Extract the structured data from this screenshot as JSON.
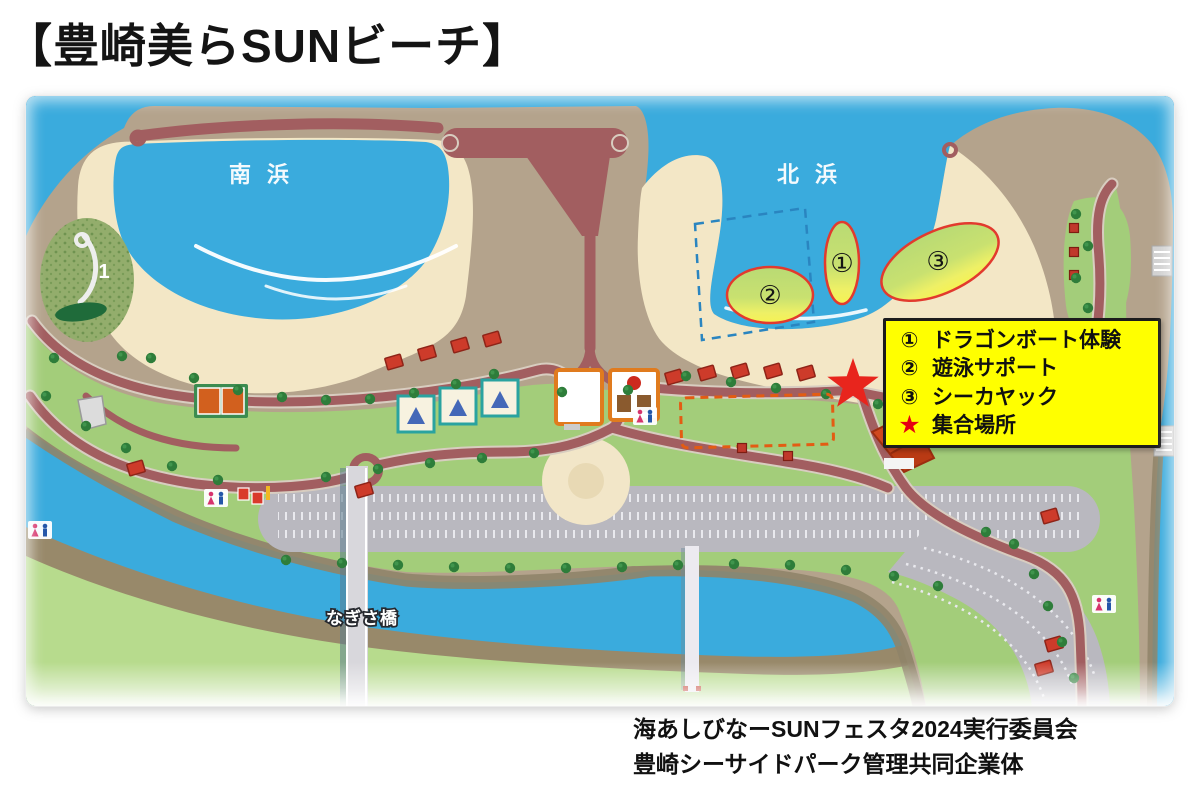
{
  "page": {
    "title": "【豊崎美らSUNビーチ】",
    "credits": [
      "海あしびなーSUNフェスタ2024実行委員会",
      "豊崎シーサイドパーク管理共同企業体"
    ]
  },
  "map": {
    "south_beach_label": "南浜",
    "north_beach_label": "北浜",
    "bridge_label": "なぎさ橋",
    "garden_marker": "1",
    "activities": [
      {
        "symbol": "①",
        "name": "ドラゴンボート体験"
      },
      {
        "symbol": "②",
        "name": "遊泳サポート"
      },
      {
        "symbol": "③",
        "name": "シーカヤック"
      }
    ],
    "meeting_point": {
      "symbol": "★",
      "name": "集合場所"
    }
  },
  "legend": {
    "items": [
      {
        "symbol": "①",
        "label": "ドラゴンボート体験"
      },
      {
        "symbol": "②",
        "label": "遊泳サポート"
      },
      {
        "symbol": "③",
        "label": "シーカヤック"
      },
      {
        "symbol": "★",
        "label": "集合場所"
      }
    ],
    "background": "#ffff00",
    "border": "#1c1c1c"
  },
  "palette": {
    "water": "#3aabdd",
    "sand": "#f3e7c6",
    "park_green": "#a3cd7a",
    "shore_green": "#b7db8d",
    "seawall_tan": "#b4a38c",
    "bank_brown": "#98896a",
    "road": "#a25e60",
    "parking_gray": "#b9b8bf",
    "activity_fill_top": "#b9da74",
    "activity_fill_bottom": "#f6f253",
    "marker_ring": "#e23a2e",
    "star_red": "#e8251d"
  }
}
